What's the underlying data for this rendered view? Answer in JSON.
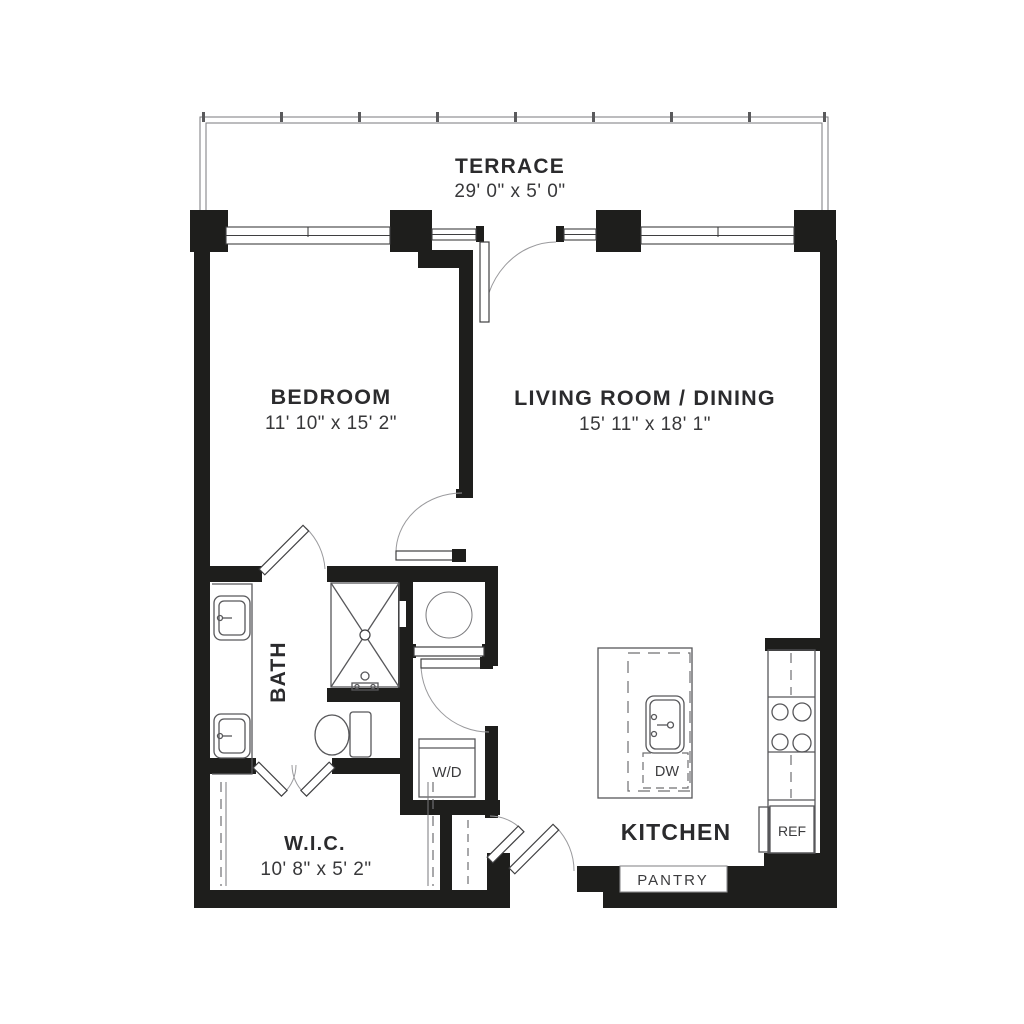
{
  "rooms": {
    "terrace": {
      "name": "TERRACE",
      "dims": "29' 0\" x 5' 0\""
    },
    "bedroom": {
      "name": "BEDROOM",
      "dims": "11' 10\" x 15' 2\""
    },
    "living_dining": {
      "name": "LIVING ROOM / DINING",
      "dims": "15' 11\" x 18' 1\""
    },
    "bath": {
      "name": "BATH"
    },
    "wic": {
      "name": "W.I.C.",
      "dims": "10' 8\" x 5' 2\""
    },
    "kitchen": {
      "name": "KITCHEN"
    },
    "pantry": {
      "name": "PANTRY"
    }
  },
  "appliances": {
    "washer_dryer": "W/D",
    "dishwasher": "DW",
    "refrigerator": "REF"
  },
  "colors": {
    "wall": "#1e1e1c",
    "fixture_line": "#57575a",
    "swing_line": "#9a9a9d",
    "text": "#2b2b2d"
  }
}
